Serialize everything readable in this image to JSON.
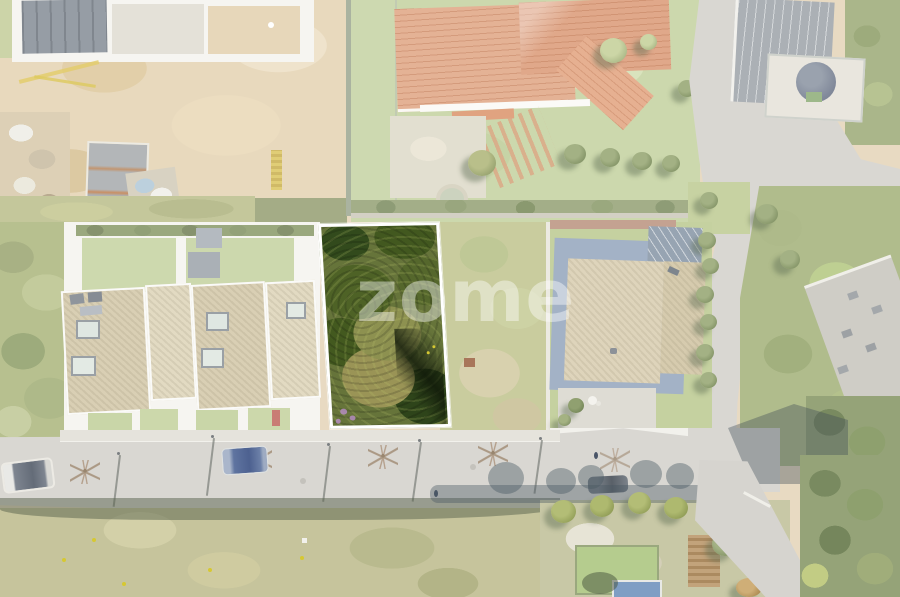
{
  "watermark": {
    "text": "zome"
  },
  "palette": {
    "wash_white": "#ffffff",
    "plot_border": "#ffffff",
    "plot_green_dark": "#3c5422",
    "plot_green_base": "#66743a",
    "plot_olive": "#9a9456",
    "roof_terracotta": "#e4b295",
    "roof_gravel_tan": "#d9cfb4",
    "road_gray": "#d9d7d2",
    "sidewalk_gray": "#e5e3dc",
    "lawn_green": "#ccd8ad",
    "dirt_tan": "#e8dac2",
    "estate_white": "#f6f5f1",
    "car_blue": "#8795ae",
    "car_dark": "#9aa0a7",
    "shadow_green": "#5a6a4a",
    "flower_purple": "#b48cc0"
  }
}
